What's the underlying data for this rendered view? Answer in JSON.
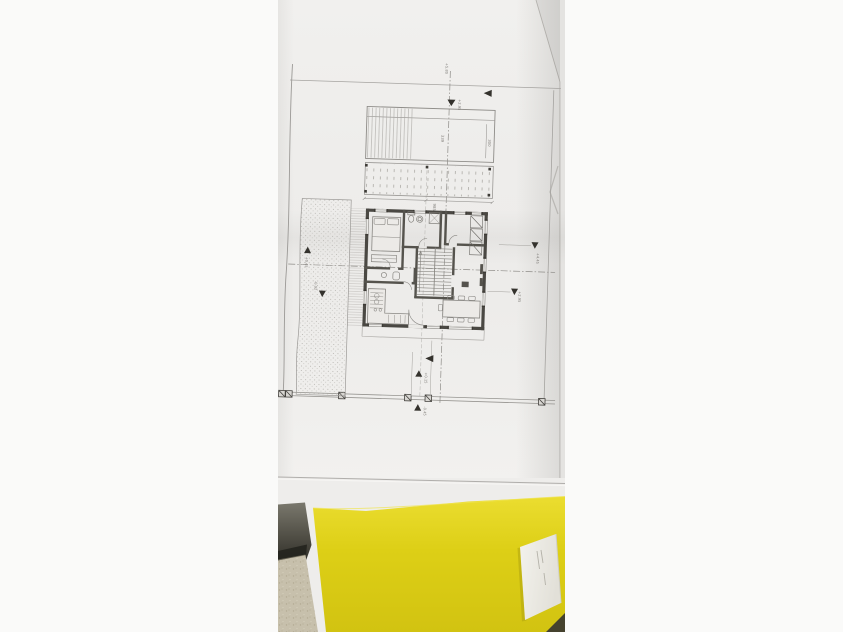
{
  "colors": {
    "canvas_bg": "#fafaf9",
    "paper": "#edecea",
    "paper_light": "#f2f1ef",
    "table": "#eeedeb",
    "table_wedge": "#e4e3e1",
    "folder_yellow_light": "#ebdd30",
    "folder_yellow": "#ddcf16",
    "folder_yellow_dark": "#d2c311",
    "floor_beige": "#c7c0ac",
    "dark_object_top": "#7a786d",
    "dark_object_mid": "#4f4d44",
    "dark_object_bottom": "#2b2a25",
    "card_white": "#f3f2ed",
    "card_shade": "#e2e0d8",
    "ink_wall": "#4a4843",
    "ink_line": "#8e8c88",
    "ink_dark": "#34322d"
  },
  "plan": {
    "dim_labels": {
      "terrace_width": "339",
      "terrace_depth": "300",
      "deck_width": "985"
    },
    "level_labels": {
      "top_axis": "+5.80",
      "top": "+2.95",
      "left_upper": "+0.45",
      "left_lower": "-0.02",
      "right_upper": "+4.45",
      "right_lower": "+2.95",
      "bottom_upper": "+0.15",
      "bottom_lower": "-0.45"
    }
  }
}
